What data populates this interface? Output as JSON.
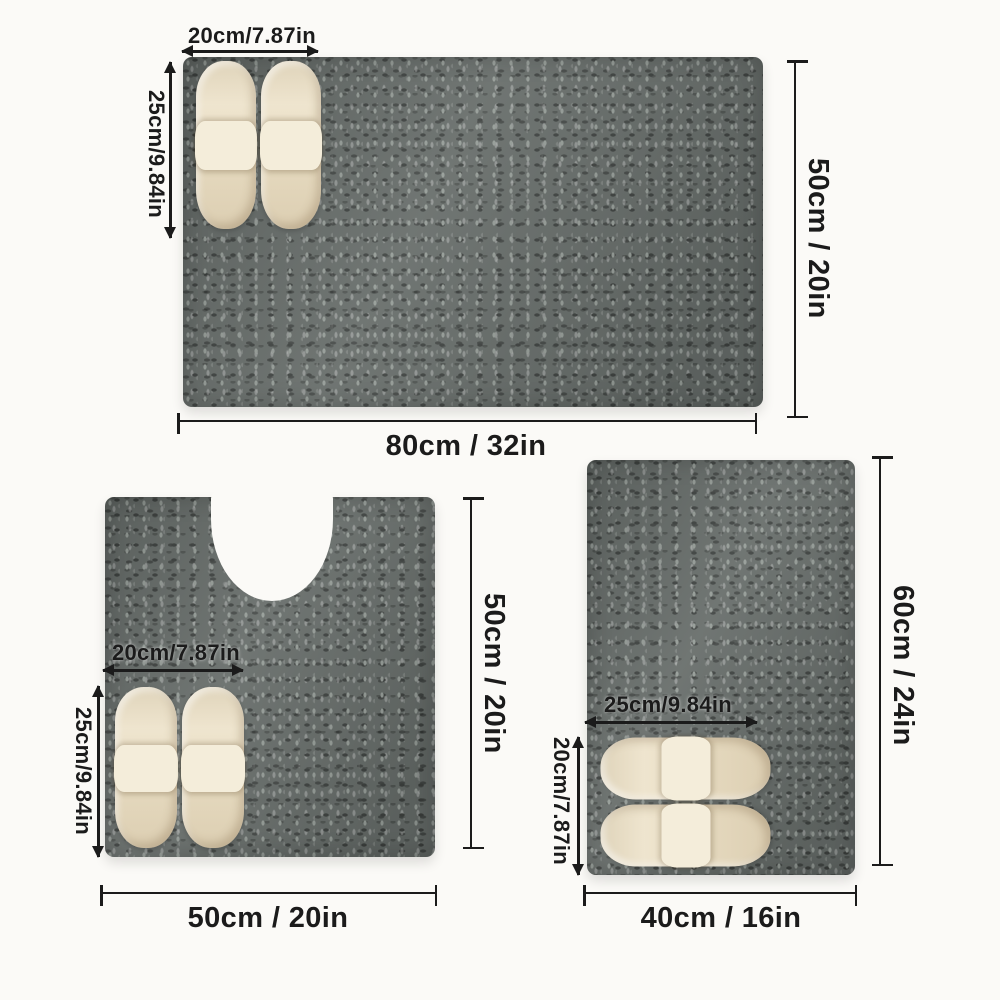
{
  "colors": {
    "bg": "#fbfaf7",
    "ink": "#1b1b1b",
    "mat": "#646a67",
    "mat-dark": "#3c403e",
    "mat-light": "#939a95",
    "slipper": "#ebdfc4",
    "slipper-strap": "#f4edda"
  },
  "mats": {
    "top": {
      "width_label": "80cm / 32in",
      "height_label": "50cm / 20in",
      "slipper_width_label": "20cm/7.87in",
      "slipper_height_label": "25cm/9.84in"
    },
    "contour": {
      "width_label": "50cm / 20in",
      "height_label": "50cm / 20in",
      "slipper_width_label": "20cm/7.87in",
      "slipper_height_label": "25cm/9.84in"
    },
    "small": {
      "width_label": "40cm / 16in",
      "height_label": "60cm / 24in",
      "slipper_width_label": "25cm/9.84in",
      "slipper_height_label": "20cm/7.87in"
    }
  }
}
